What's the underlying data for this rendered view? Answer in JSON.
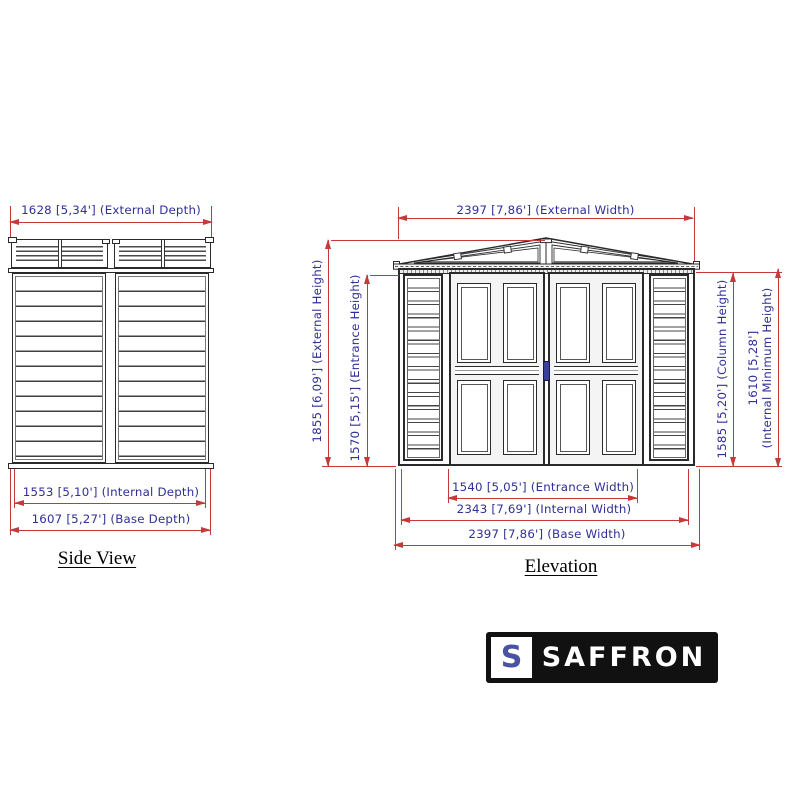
{
  "side_view": {
    "title": "Side View",
    "dims": {
      "external_depth": "1628 [5,34'] (External Depth)",
      "internal_depth": "1553 [5,10'] (Internal Depth)",
      "base_depth": "1607 [5,27'] (Base Depth)"
    }
  },
  "elevation": {
    "title": "Elevation",
    "dims": {
      "external_width": "2397 [7,86'] (External Width)",
      "external_height": "1855 [6,09'] (External Height)",
      "entrance_height": "1570 [5,15'] (Entrance Height)",
      "column_height": "1585 [5,20'] (Column Height)",
      "internal_min_height_value": "1610 [5,28']",
      "internal_min_height_label": "(Internal Minimum Height)",
      "entrance_width": "1540 [5,05'] (Entrance Width)",
      "internal_width": "2343 [7,69'] (Internal Width)",
      "base_width": "2397 [7,86'] (Base Width)"
    }
  },
  "logo": {
    "monogram": "S",
    "name": "SAFFRON"
  },
  "colors": {
    "dim_line": "#c43a3a",
    "dim_text": "#2f2f98",
    "line": "#2a2a2a",
    "logo_bg": "#111111",
    "logo_monogram": "#4a52a3",
    "door_handle": "#3b3f9c"
  }
}
